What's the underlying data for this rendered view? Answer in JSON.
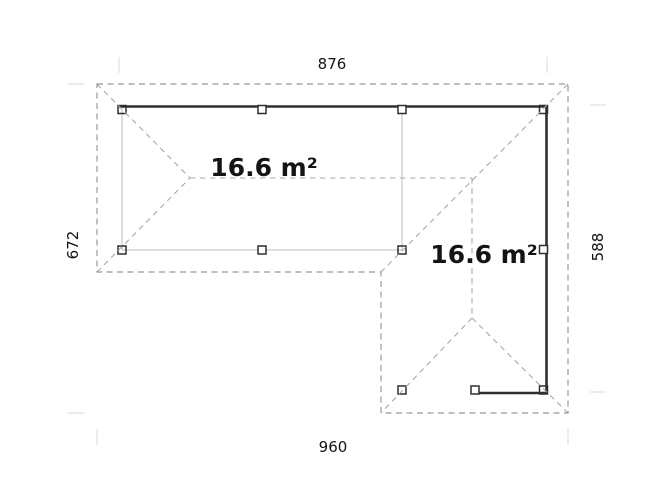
{
  "drawing": {
    "type": "floor-plan",
    "dimensions": {
      "top": "876",
      "bottom": "960",
      "left": "672",
      "right": "588"
    },
    "areas": {
      "left_wing": "16.6 m²",
      "right_wing": "16.6 m²"
    }
  },
  "colors": {
    "background": "#ffffff",
    "outline": "#999999",
    "roof": "#a8a8a8",
    "wall": "#2f2f2f",
    "beam": "#bcbcbc",
    "tick": "#dedede",
    "text": "#141414"
  }
}
